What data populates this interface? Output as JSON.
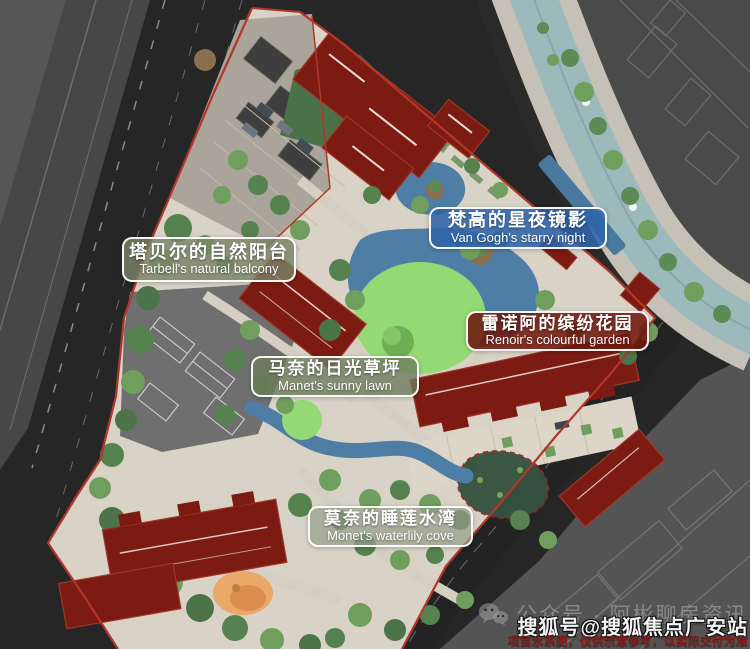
{
  "map": {
    "site_name_labels": [
      {
        "id": "tarbell",
        "zh": "塔贝尔的自然阳台",
        "en": "Tarbell's natural balcony"
      },
      {
        "id": "vangogh",
        "zh": "梵高的星夜镜影",
        "en": "Van Gogh's starry night"
      },
      {
        "id": "renoir",
        "zh": "雷诺阿的缤纷花园",
        "en": "Renoir's colourful garden"
      },
      {
        "id": "manet",
        "zh": "马奈的日光草坪",
        "en": "Manet's sunny lawn"
      },
      {
        "id": "monet",
        "zh": "莫奈的睡莲水湾",
        "en": "Monet's waterlily cove"
      }
    ]
  },
  "watermarks": {
    "wechat_account": "公众号 · 阿彬聊房资讯",
    "sohu_account": "搜狐号@搜狐焦点广安站",
    "disclaimer": "项目水系图，仅供示意参考，以实际交付为准"
  },
  "colors": {
    "boundary_red": "#b2372a",
    "building_red": "#7b1b12",
    "pond_blue": "#4e7ea6",
    "river_teal": "#9cb9bc",
    "lawn_bright": "#93da74",
    "tree_green": "#5e8a55",
    "road_dark": "#262626",
    "paving_light": "#d9d2c6",
    "label_blue_bg": "#2f64a8",
    "label_red_bg": "#6e1910",
    "label_olive_bg": "#7a8a68"
  }
}
